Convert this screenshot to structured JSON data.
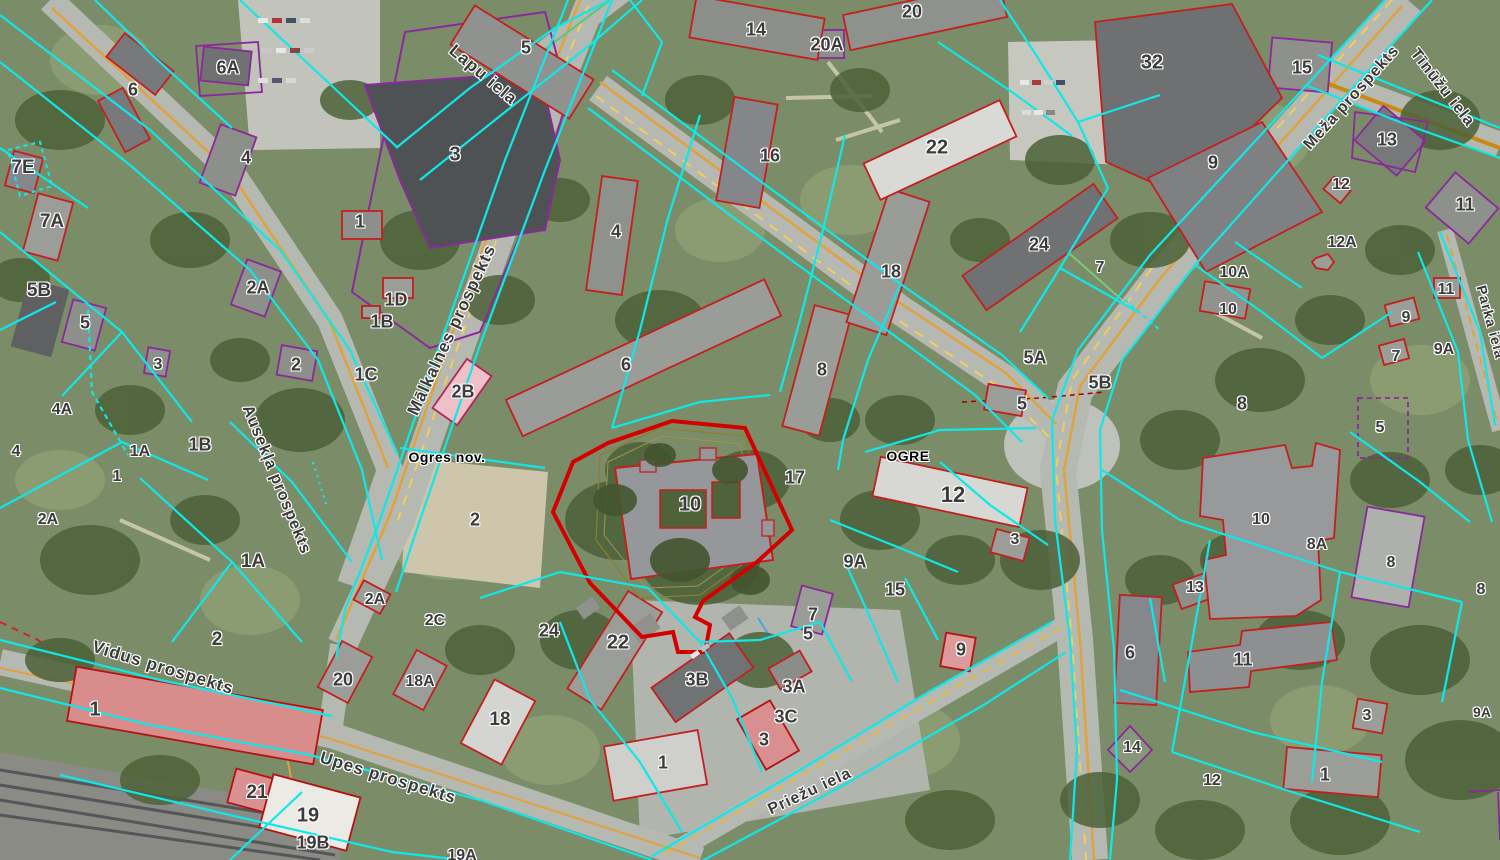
{
  "map": {
    "legend_colors": {
      "parcel_boundary": "#0ee8e8",
      "building_outline_red": "#c41f1f",
      "building_outline_purple": "#8a2a9a",
      "road_centerline": "#e0a23c",
      "selected_parcel": "#d40000"
    },
    "region_labels": [
      {
        "text": "Ogres nov.",
        "x": 447,
        "y": 457
      },
      {
        "text": "OGRE",
        "x": 908,
        "y": 456
      }
    ],
    "street_labels": [
      {
        "text": "Lapu iela",
        "x": 483,
        "y": 75,
        "angle": 40,
        "size": 17
      },
      {
        "text": "Mālkalnes prospekts",
        "x": 452,
        "y": 330,
        "angle": -65,
        "size": 17
      },
      {
        "text": "Ausekļa prospekts",
        "x": 276,
        "y": 480,
        "angle": 68,
        "size": 16
      },
      {
        "text": "Vidus prospekts",
        "x": 163,
        "y": 668,
        "angle": 17,
        "size": 17
      },
      {
        "text": "Upes prospekts",
        "x": 388,
        "y": 778,
        "angle": 17,
        "size": 17
      },
      {
        "text": "Priežu iela",
        "x": 810,
        "y": 792,
        "angle": -25,
        "size": 16
      },
      {
        "text": "Meža prospekts",
        "x": 1352,
        "y": 98,
        "angle": -48,
        "size": 16
      },
      {
        "text": "Tīnūžu iela",
        "x": 1442,
        "y": 88,
        "angle": 52,
        "size": 16
      },
      {
        "text": "Parka iela",
        "x": 1491,
        "y": 322,
        "angle": 75,
        "size": 14
      }
    ],
    "parcel_labels": [
      {
        "text": "6A",
        "x": 228,
        "y": 68,
        "size": 18
      },
      {
        "text": "6",
        "x": 133,
        "y": 90,
        "size": 18
      },
      {
        "text": "7E",
        "x": 23,
        "y": 168,
        "size": 19
      },
      {
        "text": "7A",
        "x": 52,
        "y": 222,
        "size": 19
      },
      {
        "text": "5B",
        "x": 39,
        "y": 291,
        "size": 19
      },
      {
        "text": "5",
        "x": 85,
        "y": 323,
        "size": 18
      },
      {
        "text": "3",
        "x": 158,
        "y": 365,
        "size": 16
      },
      {
        "text": "4A",
        "x": 62,
        "y": 410,
        "size": 16
      },
      {
        "text": "4",
        "x": 16,
        "y": 452,
        "size": 16
      },
      {
        "text": "1A",
        "x": 140,
        "y": 452,
        "size": 16
      },
      {
        "text": "1B",
        "x": 200,
        "y": 445,
        "size": 18
      },
      {
        "text": "1",
        "x": 117,
        "y": 477,
        "size": 16
      },
      {
        "text": "2A",
        "x": 48,
        "y": 520,
        "size": 16
      },
      {
        "text": "1A",
        "x": 253,
        "y": 562,
        "size": 19
      },
      {
        "text": "2A",
        "x": 375,
        "y": 600,
        "size": 16
      },
      {
        "text": "2C",
        "x": 435,
        "y": 621,
        "size": 16
      },
      {
        "text": "2",
        "x": 217,
        "y": 640,
        "size": 19
      },
      {
        "text": "20",
        "x": 343,
        "y": 680,
        "size": 18
      },
      {
        "text": "18A",
        "x": 420,
        "y": 682,
        "size": 16
      },
      {
        "text": "18",
        "x": 500,
        "y": 720,
        "size": 19
      },
      {
        "text": "1",
        "x": 95,
        "y": 710,
        "size": 20
      },
      {
        "text": "21",
        "x": 257,
        "y": 793,
        "size": 19
      },
      {
        "text": "19",
        "x": 308,
        "y": 816,
        "size": 20
      },
      {
        "text": "19B",
        "x": 313,
        "y": 843,
        "size": 18
      },
      {
        "text": "19A",
        "x": 462,
        "y": 856,
        "size": 16
      },
      {
        "text": "5",
        "x": 526,
        "y": 48,
        "size": 18
      },
      {
        "text": "3",
        "x": 455,
        "y": 155,
        "size": 20
      },
      {
        "text": "4",
        "x": 246,
        "y": 158,
        "size": 18
      },
      {
        "text": "1",
        "x": 360,
        "y": 222,
        "size": 18
      },
      {
        "text": "2A",
        "x": 258,
        "y": 288,
        "size": 18
      },
      {
        "text": "1D",
        "x": 396,
        "y": 300,
        "size": 18
      },
      {
        "text": "1B",
        "x": 382,
        "y": 322,
        "size": 18
      },
      {
        "text": "2",
        "x": 296,
        "y": 365,
        "size": 18
      },
      {
        "text": "1C",
        "x": 366,
        "y": 375,
        "size": 18
      },
      {
        "text": "2B",
        "x": 463,
        "y": 392,
        "size": 18
      },
      {
        "text": "4",
        "x": 616,
        "y": 232,
        "size": 18
      },
      {
        "text": "6",
        "x": 626,
        "y": 365,
        "size": 18
      },
      {
        "text": "14",
        "x": 756,
        "y": 30,
        "size": 18
      },
      {
        "text": "16",
        "x": 770,
        "y": 156,
        "size": 18
      },
      {
        "text": "8",
        "x": 822,
        "y": 370,
        "size": 18
      },
      {
        "text": "10",
        "x": 690,
        "y": 505,
        "size": 20
      },
      {
        "text": "17",
        "x": 795,
        "y": 478,
        "size": 18
      },
      {
        "text": "2",
        "x": 475,
        "y": 520,
        "size": 18
      },
      {
        "text": "24",
        "x": 549,
        "y": 631,
        "size": 18
      },
      {
        "text": "22",
        "x": 618,
        "y": 643,
        "size": 20
      },
      {
        "text": "9A",
        "x": 855,
        "y": 562,
        "size": 18
      },
      {
        "text": "15",
        "x": 895,
        "y": 590,
        "size": 18
      },
      {
        "text": "7",
        "x": 813,
        "y": 615,
        "size": 18
      },
      {
        "text": "5",
        "x": 808,
        "y": 634,
        "size": 18
      },
      {
        "text": "3B",
        "x": 697,
        "y": 680,
        "size": 18
      },
      {
        "text": "3A",
        "x": 794,
        "y": 687,
        "size": 18
      },
      {
        "text": "3C",
        "x": 786,
        "y": 717,
        "size": 18
      },
      {
        "text": "3",
        "x": 764,
        "y": 740,
        "size": 18
      },
      {
        "text": "1",
        "x": 663,
        "y": 763,
        "size": 18
      },
      {
        "text": "20",
        "x": 912,
        "y": 12,
        "size": 18
      },
      {
        "text": "20A",
        "x": 827,
        "y": 45,
        "size": 18
      },
      {
        "text": "22",
        "x": 937,
        "y": 148,
        "size": 20
      },
      {
        "text": "18",
        "x": 891,
        "y": 272,
        "size": 18
      },
      {
        "text": "24",
        "x": 1039,
        "y": 245,
        "size": 18
      },
      {
        "text": "7",
        "x": 1100,
        "y": 268,
        "size": 16
      },
      {
        "text": "5A",
        "x": 1035,
        "y": 358,
        "size": 18
      },
      {
        "text": "5B",
        "x": 1100,
        "y": 383,
        "size": 18
      },
      {
        "text": "5",
        "x": 1022,
        "y": 404,
        "size": 18
      },
      {
        "text": "12",
        "x": 953,
        "y": 495,
        "size": 22
      },
      {
        "text": "3",
        "x": 1015,
        "y": 540,
        "size": 16
      },
      {
        "text": "9",
        "x": 961,
        "y": 650,
        "size": 18
      },
      {
        "text": "32",
        "x": 1152,
        "y": 63,
        "size": 20
      },
      {
        "text": "9",
        "x": 1213,
        "y": 163,
        "size": 18
      },
      {
        "text": "15",
        "x": 1302,
        "y": 68,
        "size": 18
      },
      {
        "text": "13",
        "x": 1387,
        "y": 140,
        "size": 18
      },
      {
        "text": "12",
        "x": 1341,
        "y": 185,
        "size": 16
      },
      {
        "text": "11",
        "x": 1465,
        "y": 205,
        "size": 18
      },
      {
        "text": "12A",
        "x": 1342,
        "y": 243,
        "size": 16
      },
      {
        "text": "10A",
        "x": 1234,
        "y": 273,
        "size": 16
      },
      {
        "text": "10",
        "x": 1228,
        "y": 310,
        "size": 16
      },
      {
        "text": "11",
        "x": 1446,
        "y": 290,
        "size": 16
      },
      {
        "text": "9",
        "x": 1406,
        "y": 318,
        "size": 16
      },
      {
        "text": "9A",
        "x": 1444,
        "y": 350,
        "size": 16
      },
      {
        "text": "7",
        "x": 1396,
        "y": 357,
        "size": 16
      },
      {
        "text": "8",
        "x": 1242,
        "y": 404,
        "size": 18
      },
      {
        "text": "5",
        "x": 1380,
        "y": 428,
        "size": 16
      },
      {
        "text": "10",
        "x": 1261,
        "y": 520,
        "size": 16
      },
      {
        "text": "8A",
        "x": 1317,
        "y": 545,
        "size": 16
      },
      {
        "text": "8",
        "x": 1391,
        "y": 563,
        "size": 16
      },
      {
        "text": "8",
        "x": 1481,
        "y": 590,
        "size": 16
      },
      {
        "text": "13",
        "x": 1195,
        "y": 588,
        "size": 16
      },
      {
        "text": "6",
        "x": 1130,
        "y": 653,
        "size": 18
      },
      {
        "text": "11",
        "x": 1243,
        "y": 660,
        "size": 18
      },
      {
        "text": "3",
        "x": 1367,
        "y": 716,
        "size": 16
      },
      {
        "text": "9A",
        "x": 1482,
        "y": 712,
        "size": 14
      },
      {
        "text": "14",
        "x": 1132,
        "y": 748,
        "size": 16
      },
      {
        "text": "12",
        "x": 1212,
        "y": 781,
        "size": 16
      },
      {
        "text": "1",
        "x": 1325,
        "y": 775,
        "size": 18
      }
    ]
  }
}
